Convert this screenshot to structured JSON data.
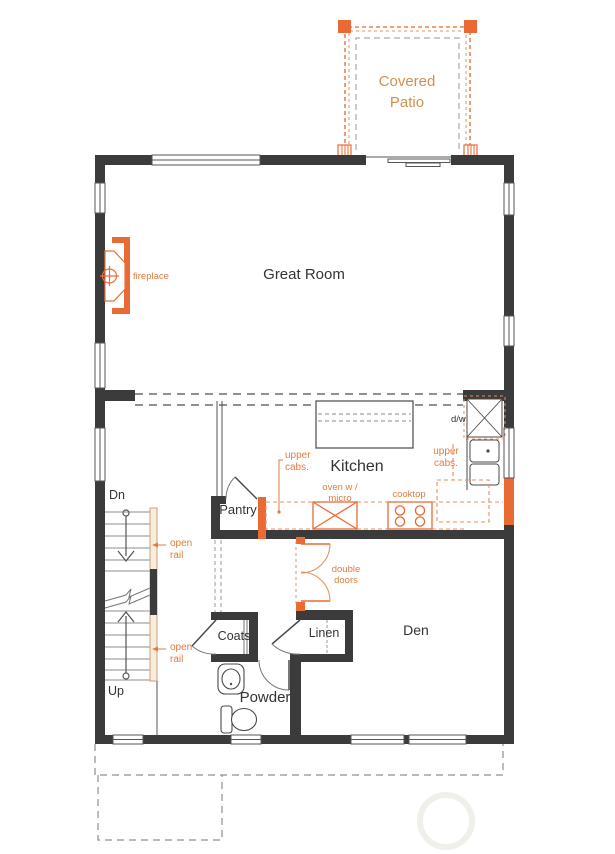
{
  "plan": {
    "labels": {
      "covered_patio": {
        "l1": "Covered",
        "l2": "Patio"
      },
      "great_room": "Great Room",
      "fireplace": "fireplace",
      "kitchen": "Kitchen",
      "pantry": "Pantry",
      "upper_cabs": {
        "l1": "upper",
        "l2": "cabs."
      },
      "oven": {
        "l1": "oven w /",
        "l2": "micro"
      },
      "cooktop": "cooktop",
      "dw": "d/w",
      "dn": "Dn",
      "up": "Up",
      "open_rail": {
        "l1": "open",
        "l2": "rail"
      },
      "double_doors": {
        "l1": "double",
        "l2": "doors"
      },
      "coats": "Coats",
      "linen": "Linen",
      "powder": "Powder",
      "den": "Den"
    },
    "colors": {
      "wall": "#3b3b3b",
      "accent_fill": "#ea6a36",
      "accent_line": "#e8905f",
      "label_orange": "#dc7d3e",
      "patio_text": "#d0914f",
      "dashed_gray": "#909090",
      "thin_line": "#4a4a4a"
    }
  }
}
